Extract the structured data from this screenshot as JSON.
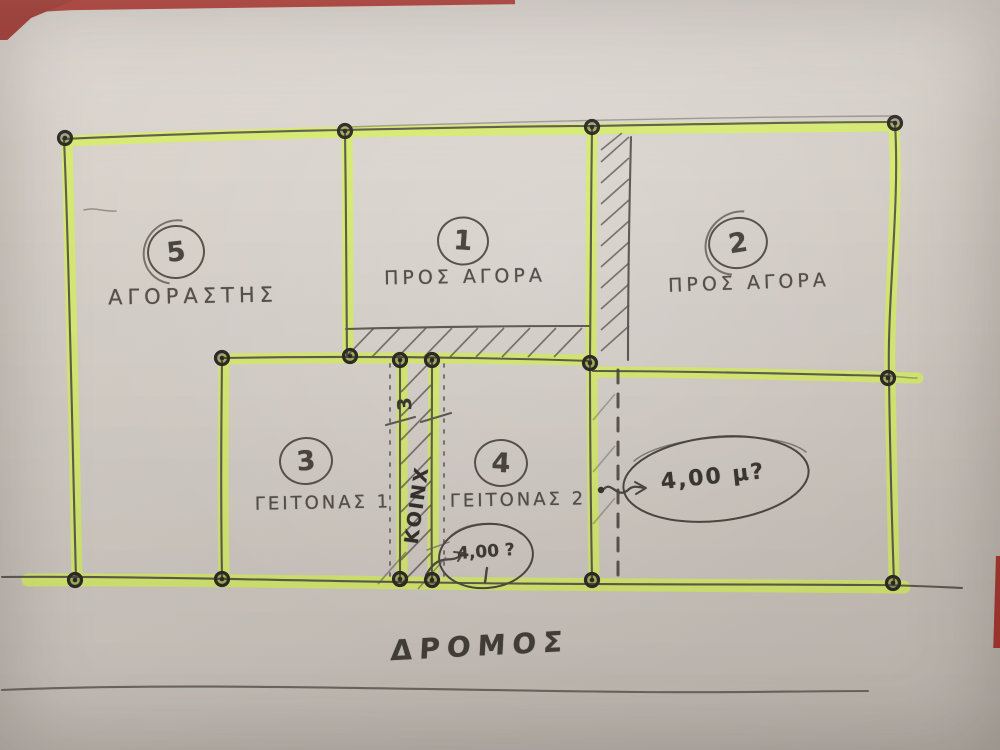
{
  "parcels": [
    {
      "number": "5",
      "label": "ΑΓΟΡΑΣΤΗΣ"
    },
    {
      "number": "1",
      "label": "ΠΡΟΣ ΑΓΟΡΑ"
    },
    {
      "number": "2",
      "label": "ΠΡΟΣ ΑΓΟΡΑ"
    },
    {
      "number": "3",
      "label": "ΓΕΙΤΟΝΑΣ 1"
    },
    {
      "number": "4",
      "label": "ΓΕΙΤΟΝΑΣ 2"
    }
  ],
  "annotations": {
    "strip_width_label": "3",
    "strip_name": "ΚΟΙΝΧ",
    "measurement_question": "4,00 μ?",
    "measurement_question_small": "4,00 ?",
    "road_label": "ΔΡΟΜΟΣ"
  },
  "colors": {
    "highlighter": "#d9f15f",
    "pencil": "#57514a",
    "marker_dark": "#2e2b26",
    "paper": "#d3ccc5",
    "table_red": "#a23730"
  }
}
